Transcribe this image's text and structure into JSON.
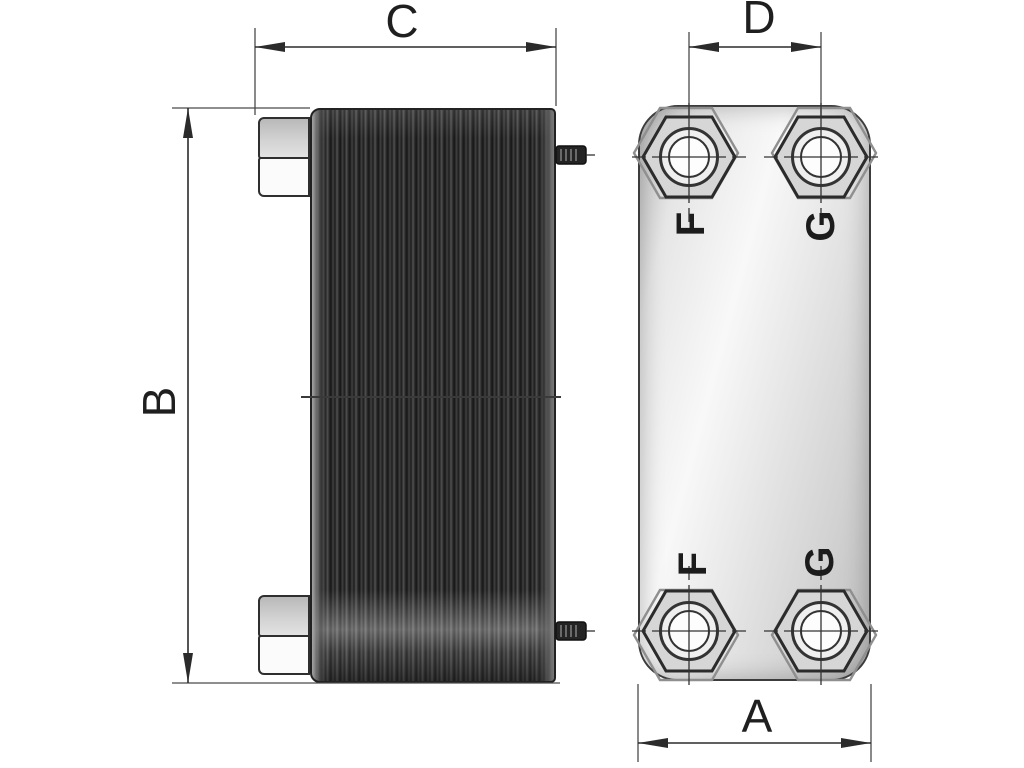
{
  "colors": {
    "line": "#2b2b2b",
    "stack": "#1e1e1e",
    "fitting_gray": "#d2d2d2",
    "plate": "#e9e9e9"
  },
  "side_view": {
    "width_label": "C",
    "height_label": "B"
  },
  "front_view": {
    "port_spacing_label": "D",
    "width_label": "A",
    "ports": [
      {
        "position": "top-left",
        "label": "F"
      },
      {
        "position": "top-right",
        "label": "G"
      },
      {
        "position": "bottom-left",
        "label": "F"
      },
      {
        "position": "bottom-right",
        "label": "G"
      }
    ]
  }
}
